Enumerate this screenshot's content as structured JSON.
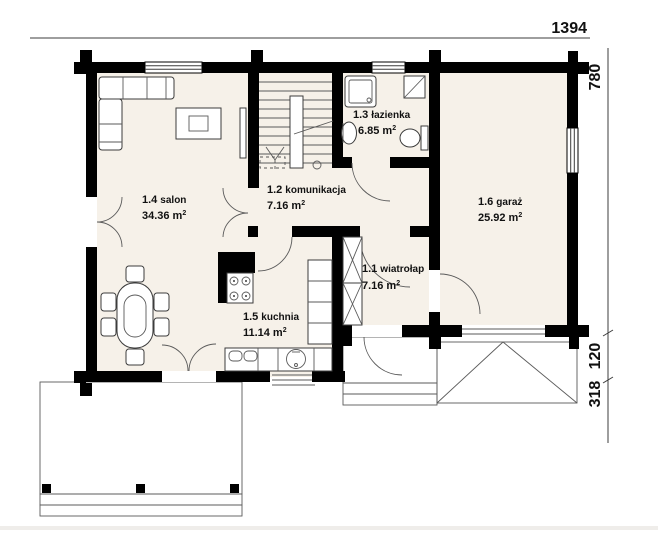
{
  "dimensions": {
    "top_width": "1394",
    "right_total": "780",
    "right_upper": "120",
    "right_lower": "318"
  },
  "rooms": [
    {
      "number": "1.1",
      "name": "wiatrołap",
      "area": "7.16"
    },
    {
      "number": "1.2",
      "name": "komunikacja",
      "area": "7.16"
    },
    {
      "number": "1.3",
      "name": "łazienka",
      "area": "6.85"
    },
    {
      "number": "1.4",
      "name": "salon",
      "area": "34.36"
    },
    {
      "number": "1.5",
      "name": "kuchnia",
      "area": "11.14"
    },
    {
      "number": "1.6",
      "name": "garaż",
      "area": "25.92"
    }
  ],
  "labels": {
    "unit": "m",
    "unit_sup": "2"
  },
  "fixtures": [
    "corner-sofa",
    "coffee-table",
    "tv-bench",
    "dining-table",
    "chairs",
    "stairs",
    "wardrobe",
    "shower",
    "washer",
    "wash-basin",
    "toilet",
    "stove",
    "kitchen-sink",
    "kitchen-cabinets",
    "terrace",
    "porch-steps",
    "driveway-apron"
  ],
  "colors": {
    "wall": "#000000",
    "floor": "#f6f1e9",
    "outline": "#3c3c3c",
    "dimension": "#111111",
    "background": "#ffffff"
  }
}
